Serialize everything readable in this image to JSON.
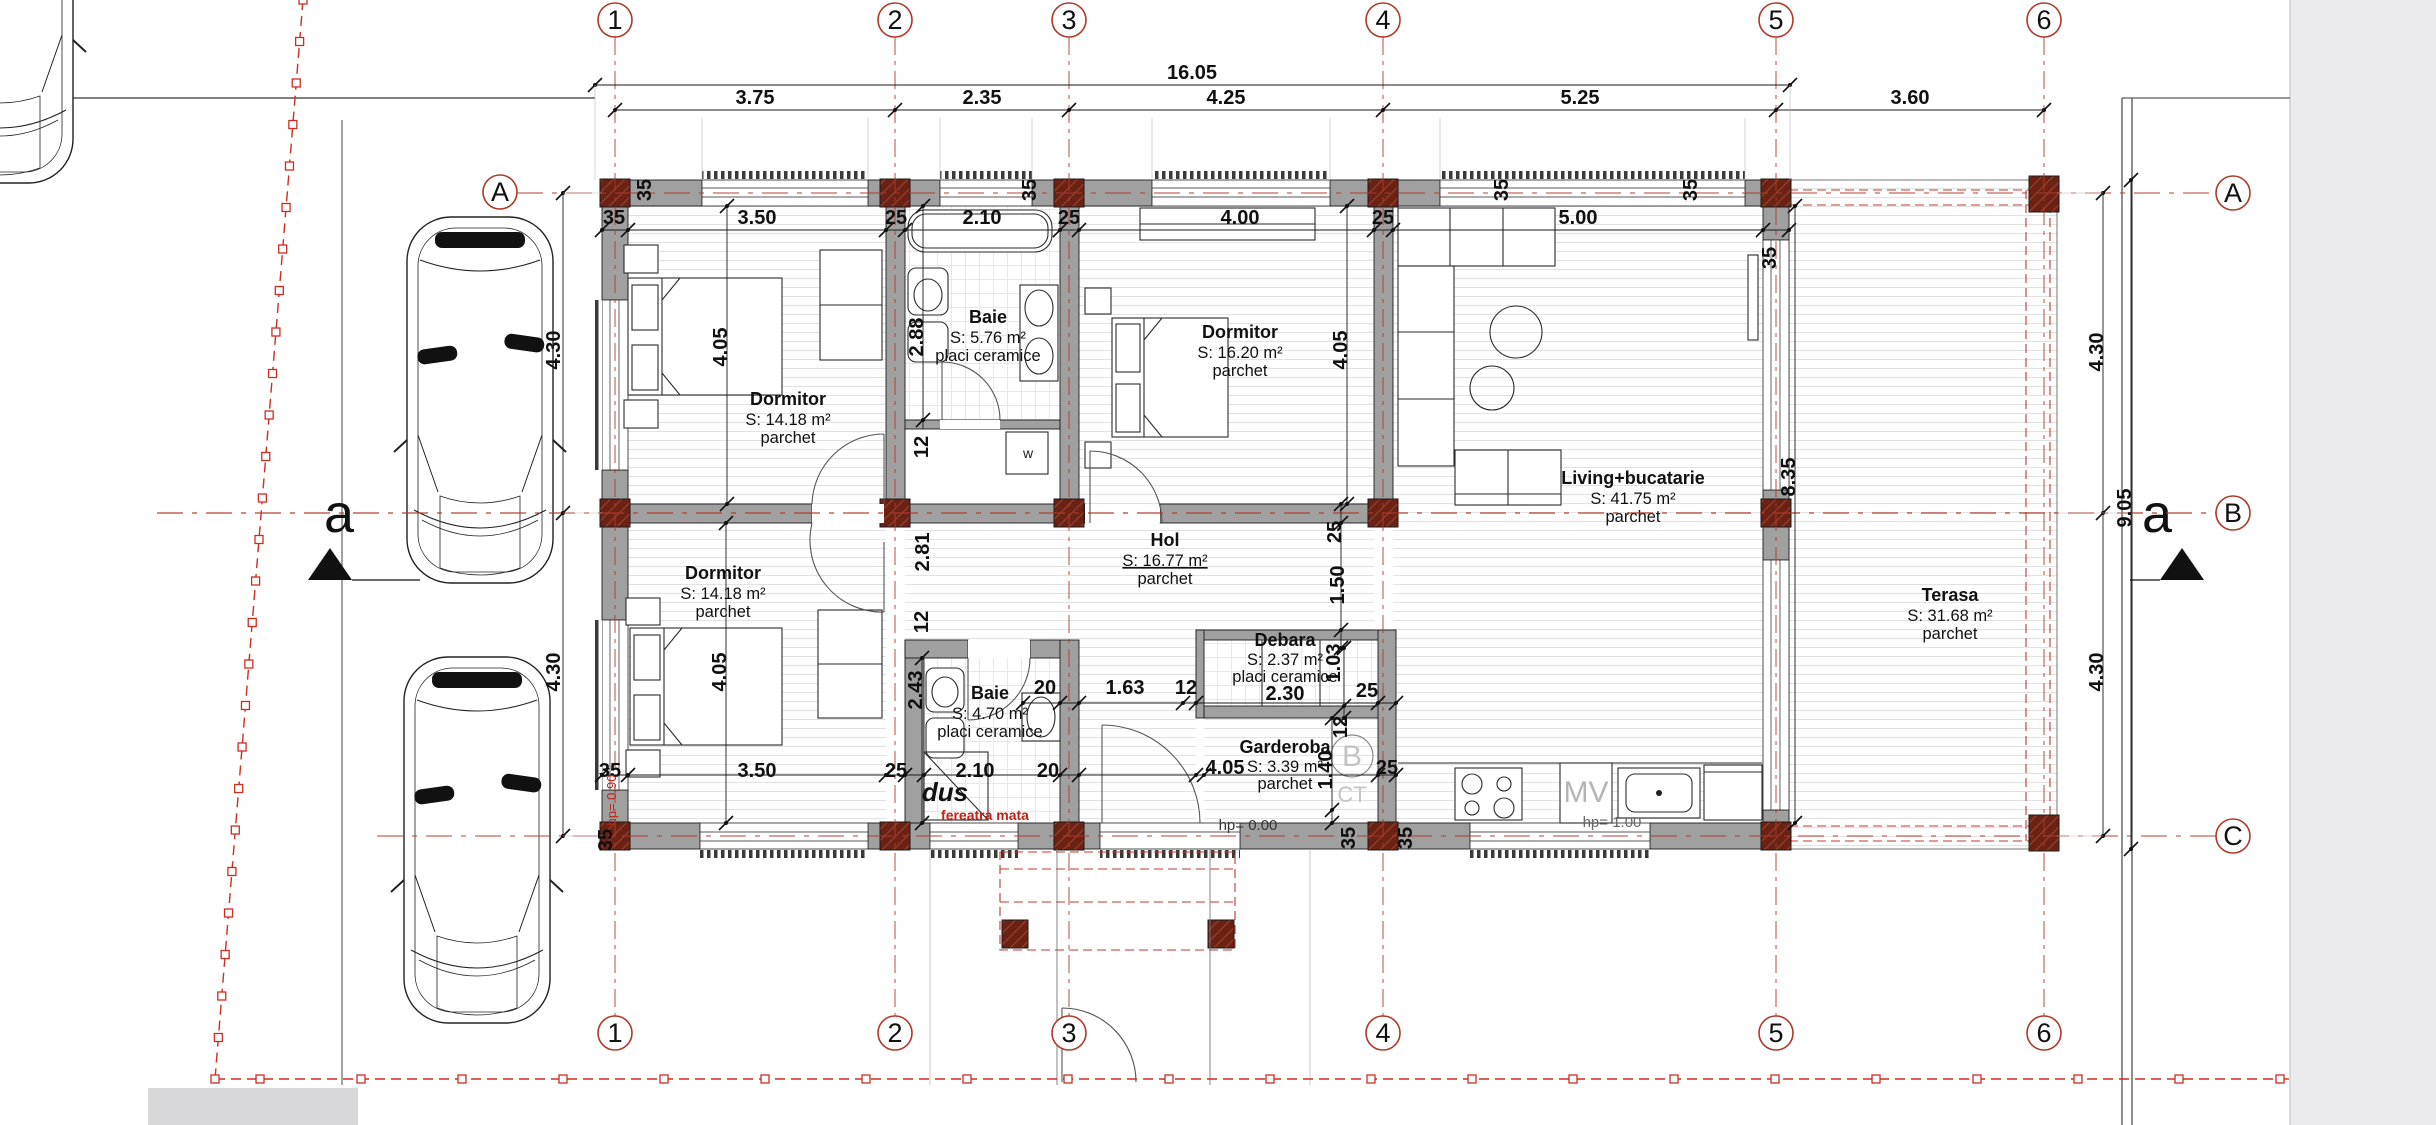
{
  "drawing": {
    "overall_width_label": "16.05",
    "section_label": "a"
  },
  "colors": {
    "axis_red": "#b0392a",
    "boundary_red": "#cf2d22",
    "annotation_red": "#c22016",
    "column_brown": "#6b2114",
    "wall_gray": "#a0a0a0",
    "panel_gray": "#ebebee",
    "muted_gray_text": "#bdbdbd"
  },
  "axes": {
    "columns": [
      {
        "label": "1",
        "x": 615
      },
      {
        "label": "2",
        "x": 895
      },
      {
        "label": "3",
        "x": 1069
      },
      {
        "label": "4",
        "x": 1383
      },
      {
        "label": "5",
        "x": 1776
      },
      {
        "label": "6",
        "x": 2044
      }
    ],
    "rows": [
      {
        "label": "A",
        "y": 193
      },
      {
        "label": "B",
        "y": 513
      },
      {
        "label": "C",
        "y": 836
      }
    ]
  },
  "rooms": [
    {
      "name": "Dormitor",
      "area": "S: 14.18 m²",
      "floor": "parchet"
    },
    {
      "name": "Baie",
      "area": "S: 5.76 m²",
      "floor": "placi ceramice"
    },
    {
      "name": "Dormitor",
      "area": "S: 16.20 m²",
      "floor": "parchet"
    },
    {
      "name": "Living+bucatarie",
      "area": "S: 41.75 m²",
      "floor": "parchet"
    },
    {
      "name": "Hol",
      "area": "S: 16.77 m²",
      "floor": "parchet"
    },
    {
      "name": "Dormitor",
      "area": "S: 14.18 m²",
      "floor": "parchet"
    },
    {
      "name": "Baie",
      "area": "S: 4.70 m²",
      "floor": "placi ceramice"
    },
    {
      "name": "Debara",
      "area": "S: 2.37 m²",
      "floor": "placi ceramice"
    },
    {
      "name": "Garderoba",
      "area": "S: 3.39 m²",
      "floor": "parchet"
    },
    {
      "name": "Terasa",
      "area": "S: 31.68 m²",
      "floor": "parchet"
    }
  ],
  "dimensions": {
    "labels": [
      {
        "t": "16.05",
        "x": 1192,
        "y": 79
      },
      {
        "t": "3.75",
        "x": 755,
        "y": 104
      },
      {
        "t": "2.35",
        "x": 982,
        "y": 104
      },
      {
        "t": "4.25",
        "x": 1226,
        "y": 104
      },
      {
        "t": "5.25",
        "x": 1580,
        "y": 104
      },
      {
        "t": "3.60",
        "x": 1910,
        "y": 104
      },
      {
        "t": "35",
        "x": 614,
        "y": 224
      },
      {
        "t": "3.50",
        "x": 757,
        "y": 224
      },
      {
        "t": "25",
        "x": 896,
        "y": 224
      },
      {
        "t": "2.10",
        "x": 982,
        "y": 224
      },
      {
        "t": "25",
        "x": 1069,
        "y": 224
      },
      {
        "t": "4.00",
        "x": 1240,
        "y": 224
      },
      {
        "t": "25",
        "x": 1383,
        "y": 224
      },
      {
        "t": "5.00",
        "x": 1578,
        "y": 224
      },
      {
        "t": "35",
        "x": 651,
        "y": 190,
        "r": 1
      },
      {
        "t": "35",
        "x": 1036,
        "y": 190,
        "r": 1
      },
      {
        "t": "35",
        "x": 1508,
        "y": 190,
        "r": 1
      },
      {
        "t": "35",
        "x": 1697,
        "y": 190,
        "r": 1
      },
      {
        "t": "35",
        "x": 1776,
        "y": 258,
        "r": 1
      },
      {
        "t": "8.35",
        "x": 1795,
        "y": 477,
        "r": 1
      },
      {
        "t": "4.30",
        "x": 560,
        "y": 350,
        "r": 1
      },
      {
        "t": "4.30",
        "x": 560,
        "y": 672,
        "r": 1
      },
      {
        "t": "4.30",
        "x": 2103,
        "y": 352,
        "r": 1
      },
      {
        "t": "9.05",
        "x": 2131,
        "y": 508,
        "r": 1
      },
      {
        "t": "4.30",
        "x": 2103,
        "y": 672,
        "r": 1
      },
      {
        "t": "4.05",
        "x": 727,
        "y": 347,
        "r": 1
      },
      {
        "t": "2.88",
        "x": 923,
        "y": 337,
        "r": 1
      },
      {
        "t": "12",
        "x": 928,
        "y": 447,
        "r": 1
      },
      {
        "t": "4.05",
        "x": 1347,
        "y": 350,
        "r": 1
      },
      {
        "t": "2.81",
        "x": 929,
        "y": 552,
        "r": 1
      },
      {
        "t": "12",
        "x": 928,
        "y": 622,
        "r": 1
      },
      {
        "t": "4.05",
        "x": 726,
        "y": 672,
        "r": 1
      },
      {
        "t": "2.43",
        "x": 922,
        "y": 690,
        "r": 1
      },
      {
        "t": "25",
        "x": 1341,
        "y": 532,
        "r": 1
      },
      {
        "t": "1.50",
        "x": 1344,
        "y": 585,
        "r": 1
      },
      {
        "t": "1.03",
        "x": 1340,
        "y": 663,
        "r": 1
      },
      {
        "t": "12",
        "x": 1347,
        "y": 727,
        "r": 1
      },
      {
        "t": "1.40",
        "x": 1332,
        "y": 770,
        "r": 1
      },
      {
        "t": "20",
        "x": 1045,
        "y": 694
      },
      {
        "t": "1.63",
        "x": 1125,
        "y": 694
      },
      {
        "t": "12",
        "x": 1186,
        "y": 694
      },
      {
        "t": "2.30",
        "x": 1285,
        "y": 700
      },
      {
        "t": "25",
        "x": 1367,
        "y": 697
      },
      {
        "t": "35",
        "x": 610,
        "y": 777
      },
      {
        "t": "3.50",
        "x": 757,
        "y": 777
      },
      {
        "t": "25",
        "x": 896,
        "y": 777
      },
      {
        "t": "2.10",
        "x": 975,
        "y": 777
      },
      {
        "t": "20",
        "x": 1048,
        "y": 777
      },
      {
        "t": "4.05",
        "x": 1225,
        "y": 774
      },
      {
        "t": "25",
        "x": 1387,
        "y": 774
      },
      {
        "t": "35",
        "x": 1355,
        "y": 838,
        "r": 1
      },
      {
        "t": "35",
        "x": 1412,
        "y": 838,
        "r": 1
      },
      {
        "t": "35",
        "x": 612,
        "y": 840,
        "r": 1
      }
    ]
  },
  "annotations": [
    {
      "t": "dus",
      "x": 945,
      "y": 801,
      "size": 26,
      "style": "italic",
      "weight": "bold",
      "color": "#111111",
      "name": "shower-label"
    },
    {
      "t": "fereatra mata",
      "x": 985,
      "y": 820,
      "size": 14,
      "weight": "bold",
      "color": "#c22016",
      "name": "matte-window-label"
    },
    {
      "t": "hp= 0.90",
      "x": 616,
      "y": 800,
      "size": 13,
      "color": "#c22016",
      "r": 1,
      "name": "parapet-height-left"
    },
    {
      "t": "hp= 0.00",
      "x": 1248,
      "y": 830,
      "size": 15,
      "color": "#333333",
      "name": "entrance-level-label"
    },
    {
      "t": "hp= 1.00",
      "x": 1612,
      "y": 827,
      "size": 15,
      "color": "#666666",
      "name": "kitchen-parapet-label"
    },
    {
      "t": "w",
      "x": 1028,
      "y": 458,
      "size": 14,
      "color": "#222222",
      "name": "washing-machine-label"
    },
    {
      "t": "MV",
      "x": 1586,
      "y": 802,
      "size": 30,
      "color": "#b5b5b5",
      "name": "microwave-label"
    },
    {
      "t": "B",
      "x": 1352,
      "y": 766,
      "size": 30,
      "color": "#c4c4c4",
      "name": "boiler-label"
    },
    {
      "t": "CT",
      "x": 1352,
      "y": 802,
      "size": 22,
      "color": "#c4c4c4",
      "name": "ct-label"
    }
  ]
}
